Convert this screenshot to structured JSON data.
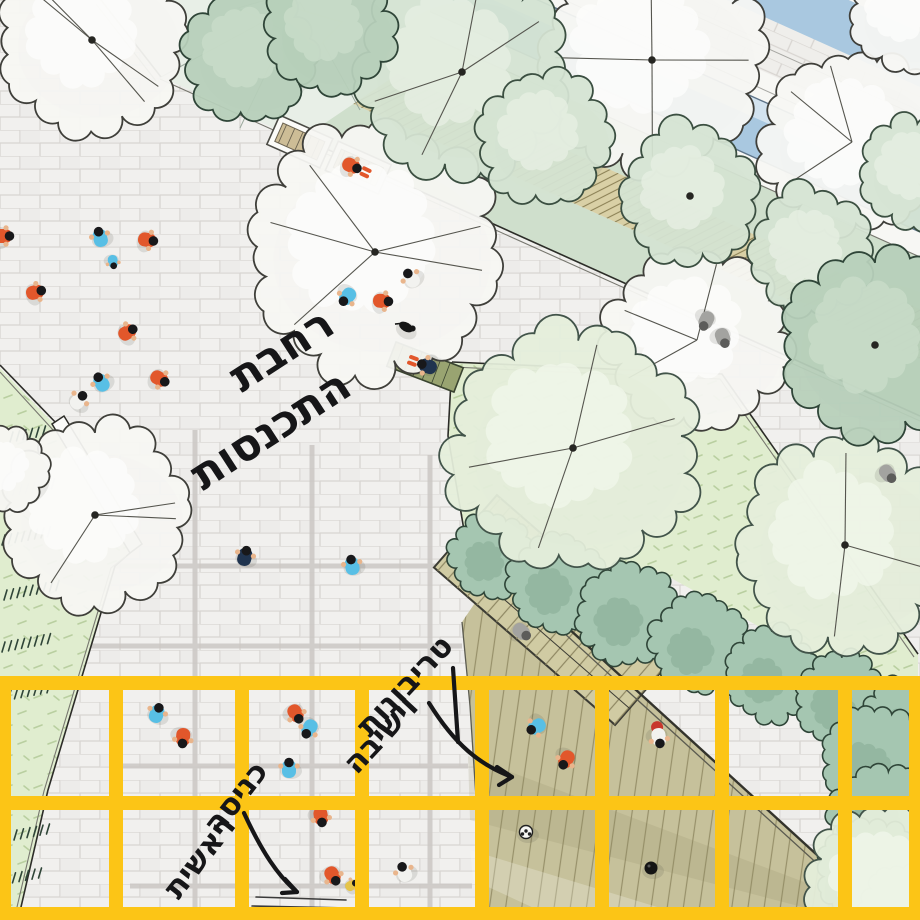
{
  "title": "site-plan-illustration",
  "palette": {
    "yellow": "#fcc516",
    "plaza": "#f1f0ee",
    "grout": "#d8d5d1",
    "greyband": "#cac7c3",
    "lawn": "#e0edcf",
    "sageband": "#cfdfcc",
    "canal": "#a9c8e0",
    "canallight": "#d3e3ef",
    "tan": "#d9d0a6",
    "hatch": "#8d8257",
    "deck": "#c6c19b",
    "plank": "#97906a",
    "platform": "#d0cba3",
    "hedge": "#a5c6b1",
    "hedgedark": "#2f4538",
    "hedgeblotch": "#86ab93",
    "ink": "#161618",
    "orange": "#e2572b",
    "blue": "#58bfe5",
    "navy": "#20344f",
    "red": "#c8372d",
    "yellowshirt": "#e5c44a",
    "whiteshirt": "#f2f2ef",
    "skin": "#e9b58c",
    "grey": "#a3a3a0"
  },
  "annotations": [
    {
      "id": "gathering-plaza",
      "lines": [
        "רחבת",
        "התכנסות"
      ],
      "pos": [
        [
          283,
          352
        ],
        [
          272,
          432
        ]
      ],
      "rot": -33,
      "size": 44
    },
    {
      "id": "tribunes-seating",
      "lines": [
        "טריבונות",
        "וישיבה"
      ],
      "pos": [
        [
          406,
          687
        ],
        [
          382,
          736
        ]
      ],
      "rot": -47,
      "size": 31
    },
    {
      "id": "main-entrance",
      "lines": [
        "כניסה",
        "ראשית"
      ],
      "pos": [
        [
          237,
          799
        ],
        [
          201,
          858
        ]
      ],
      "rot": -52,
      "size": 31
    }
  ],
  "arrows": [
    {
      "id": "arrow-to-tribunes",
      "d": "M 429,703 C 455,745 480,765 512,777",
      "head": "M512,777 L497,767 M512,777 L499,785"
    },
    {
      "id": "arrow-to-entrance",
      "d": "M 244,813 C 262,852 278,876 297,892",
      "head": "M297,892 L285,879 M297,892 L282,893"
    },
    {
      "id": "leader-line",
      "d": "M 453,668 L 458,742",
      "head": ""
    }
  ],
  "threshold_marks": [
    "M256,897 L346,900",
    "M252,906 L350,908"
  ],
  "grid": {
    "color": "#fcc516",
    "thickness": 14,
    "top": 676,
    "bottom": 920,
    "verticals": [
      4,
      116,
      242,
      362,
      482,
      602,
      722,
      845,
      916
    ],
    "horizontals": [
      683,
      803,
      914
    ]
  },
  "scene": {
    "trees": [
      {
        "x": 92,
        "y": 40,
        "r": 88,
        "f": "white",
        "rays": 4,
        "dot": 1
      },
      {
        "x": 375,
        "y": 252,
        "r": 118,
        "f": "white",
        "rays": 5,
        "dot": 1
      },
      {
        "x": 652,
        "y": 60,
        "r": 105,
        "f": "white",
        "rays": 4,
        "dot": 1
      },
      {
        "x": 852,
        "y": 142,
        "r": 86,
        "f": "white",
        "rays": 3,
        "dot": 0
      },
      {
        "x": 905,
        "y": 14,
        "r": 52,
        "f": "white",
        "rays": 0,
        "dot": 0
      },
      {
        "x": 95,
        "y": 515,
        "r": 88,
        "f": "white",
        "rays": 3,
        "dot": 1
      },
      {
        "x": 8,
        "y": 470,
        "r": 38,
        "f": "white",
        "rays": 0,
        "dot": 0
      },
      {
        "x": 697,
        "y": 340,
        "r": 85,
        "f": "white",
        "rays": 3,
        "dot": 0
      },
      {
        "x": 573,
        "y": 448,
        "r": 115,
        "f": "lawn",
        "rays": 4,
        "dot": 1
      },
      {
        "x": 845,
        "y": 545,
        "r": 100,
        "f": "lawn",
        "rays": 3,
        "dot": 1
      },
      {
        "x": 462,
        "y": 72,
        "r": 100,
        "f": "sage",
        "rays": 4,
        "dot": 1
      },
      {
        "x": 545,
        "y": 138,
        "r": 62,
        "f": "sage",
        "rays": 0,
        "dot": 0
      },
      {
        "x": 690,
        "y": 196,
        "r": 64,
        "f": "sage",
        "rays": 0,
        "dot": 1
      },
      {
        "x": 812,
        "y": 252,
        "r": 58,
        "f": "sage",
        "rays": 0,
        "dot": 0
      },
      {
        "x": 915,
        "y": 172,
        "r": 52,
        "f": "sage",
        "rays": 0,
        "dot": 0
      },
      {
        "x": 250,
        "y": 55,
        "r": 62,
        "f": "dark",
        "rays": 0,
        "dot": 0
      },
      {
        "x": 330,
        "y": 30,
        "r": 60,
        "f": "dark",
        "rays": 0,
        "dot": 0
      },
      {
        "x": 875,
        "y": 345,
        "r": 88,
        "f": "dark",
        "rays": 0,
        "dot": 1
      },
      {
        "x": 884,
        "y": 884,
        "r": 72,
        "f": "lawn",
        "rays": 0,
        "dot": 0
      }
    ],
    "hedges": [
      {
        "x": 492,
        "y": 556,
        "r": 40
      },
      {
        "x": 558,
        "y": 584,
        "r": 46
      },
      {
        "x": 628,
        "y": 614,
        "r": 48
      },
      {
        "x": 700,
        "y": 644,
        "r": 46
      },
      {
        "x": 772,
        "y": 674,
        "r": 44
      },
      {
        "x": 842,
        "y": 700,
        "r": 44
      },
      {
        "x": 900,
        "y": 722,
        "r": 38
      },
      {
        "x": 875,
        "y": 760,
        "r": 50
      },
      {
        "x": 886,
        "y": 820,
        "r": 52
      },
      {
        "x": 870,
        "y": 872,
        "r": 50
      },
      {
        "x": 905,
        "y": 908,
        "r": 42
      }
    ],
    "dash_rows": [
      {
        "x": 10,
        "y": 442,
        "n": 6
      },
      {
        "x": 6,
        "y": 497,
        "n": 8
      },
      {
        "x": 2,
        "y": 545,
        "n": 8
      },
      {
        "x": 4,
        "y": 600,
        "n": 9
      },
      {
        "x": 2,
        "y": 652,
        "n": 8
      },
      {
        "x": 8,
        "y": 700,
        "n": 7
      },
      {
        "x": 14,
        "y": 840,
        "n": 6
      },
      {
        "x": 6,
        "y": 884,
        "n": 6
      }
    ],
    "people": [
      {
        "x": 100,
        "y": 237,
        "rot": -15,
        "shirt": "blue"
      },
      {
        "x": 113,
        "y": 262,
        "rot": 170,
        "shirt": "blue",
        "small": 1
      },
      {
        "x": 148,
        "y": 240,
        "rot": 100,
        "shirt": "orange"
      },
      {
        "x": 4,
        "y": 236,
        "rot": 90,
        "shirt": "orange"
      },
      {
        "x": 36,
        "y": 292,
        "rot": 75,
        "shirt": "orange"
      },
      {
        "x": 128,
        "y": 332,
        "rot": 60,
        "shirt": "orange"
      },
      {
        "x": 101,
        "y": 382,
        "rot": -30,
        "shirt": "blue"
      },
      {
        "x": 79,
        "y": 400,
        "rot": 40,
        "shirt": "white"
      },
      {
        "x": 160,
        "y": 379,
        "rot": 120,
        "shirt": "orange"
      },
      {
        "x": 347,
        "y": 297,
        "rot": -140,
        "shirt": "blue"
      },
      {
        "x": 383,
        "y": 301,
        "rot": 95,
        "shirt": "orange"
      },
      {
        "x": 411,
        "y": 278,
        "rot": -35,
        "shirt": "white"
      },
      {
        "x": 406,
        "y": 327,
        "rot": 30,
        "variant": "dog"
      },
      {
        "x": 427,
        "y": 366,
        "rot": -70,
        "shirt": "navy",
        "variant": "sitter"
      },
      {
        "x": 352,
        "y": 166,
        "rot": 115,
        "shirt": "orange",
        "variant": "sitter"
      },
      {
        "x": 245,
        "y": 556,
        "rot": 15,
        "shirt": "navy"
      },
      {
        "x": 352,
        "y": 565,
        "rot": -10,
        "shirt": "blue"
      },
      {
        "x": 157,
        "y": 713,
        "rot": 20,
        "shirt": "blue"
      },
      {
        "x": 183,
        "y": 738,
        "rot": 185,
        "shirt": "orange"
      },
      {
        "x": 296,
        "y": 714,
        "rot": 150,
        "shirt": "orange"
      },
      {
        "x": 309,
        "y": 729,
        "rot": 210,
        "shirt": "blue"
      },
      {
        "x": 289,
        "y": 768,
        "rot": 0,
        "shirt": "blue"
      },
      {
        "x": 321,
        "y": 817,
        "rot": 170,
        "shirt": "orange"
      },
      {
        "x": 333,
        "y": 876,
        "rot": 150,
        "shirt": "orange"
      },
      {
        "x": 352,
        "y": 885,
        "rot": 60,
        "shirt": "yellow",
        "small": 1
      },
      {
        "x": 404,
        "y": 872,
        "rot": -20,
        "shirt": "white"
      },
      {
        "x": 536,
        "y": 727,
        "rot": -120,
        "shirt": "blue"
      },
      {
        "x": 566,
        "y": 760,
        "rot": -150,
        "shirt": "orange"
      },
      {
        "x": 659,
        "y": 738,
        "rot": 170,
        "shirt": "white",
        "variant": "withmat"
      },
      {
        "x": 526,
        "y": 832,
        "variant": "ball"
      },
      {
        "x": 651,
        "y": 868,
        "variant": "ball-dark"
      },
      {
        "x": 522,
        "y": 632,
        "rot": 130,
        "variant": "grey"
      },
      {
        "x": 706,
        "y": 321,
        "rot": 205,
        "variant": "grey"
      },
      {
        "x": 723,
        "y": 338,
        "rot": 160,
        "variant": "grey"
      },
      {
        "x": 888,
        "y": 474,
        "rot": 140,
        "variant": "grey"
      }
    ]
  }
}
